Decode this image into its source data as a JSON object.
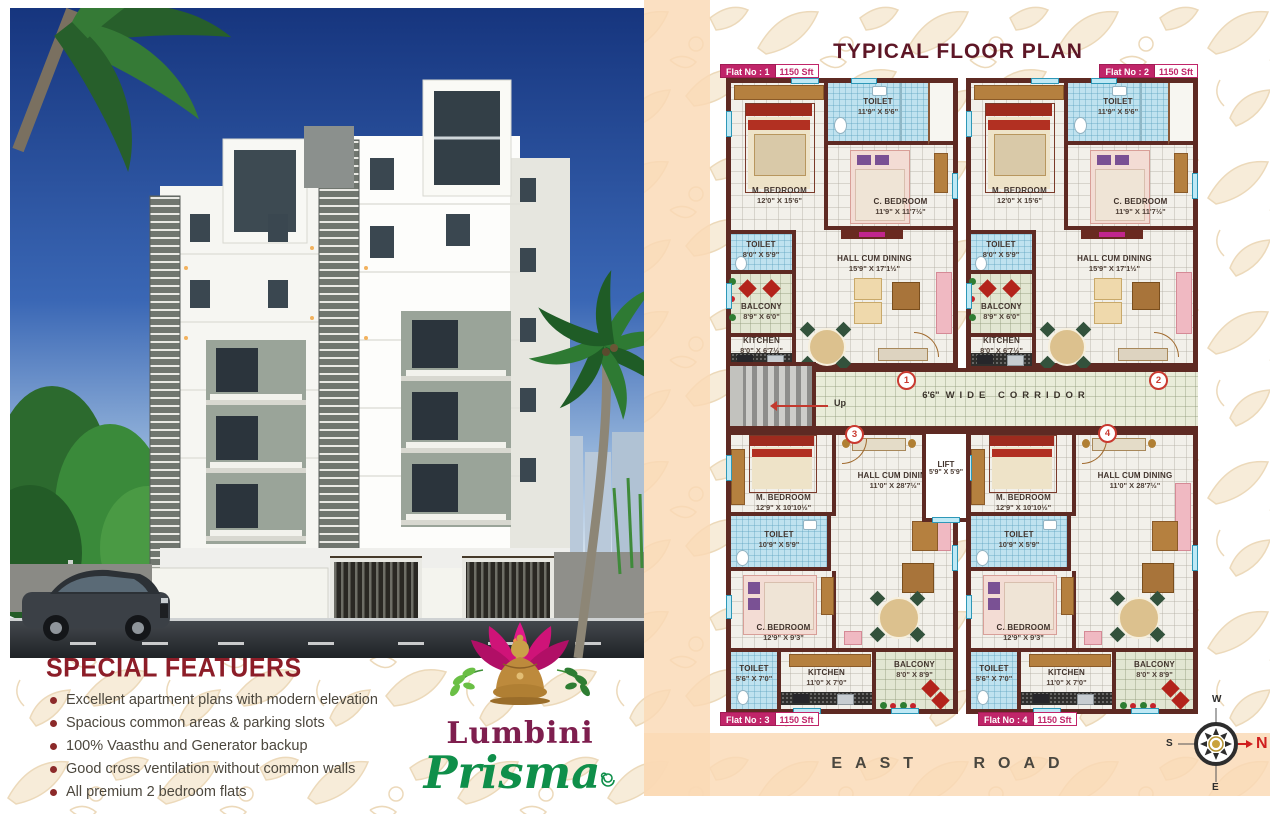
{
  "title": "TYPICAL FLOOR PLAN",
  "road_label": "EAST ROAD",
  "features": {
    "title": "SPECIAL FEATUERS",
    "items": [
      "Excellent apartment plans with modern elevation",
      "Spacious common areas & parking slots",
      "100% Vaasthu and Generator backup",
      "Good cross ventilation without common walls",
      "All premium 2 bedroom flats"
    ]
  },
  "logo": {
    "name": "Lumbini",
    "subname": "Prisma"
  },
  "flats": {
    "tags": [
      {
        "no": "Flat No : 1",
        "area": "1150 Sft"
      },
      {
        "no": "Flat No : 2",
        "area": "1150 Sft"
      },
      {
        "no": "Flat No : 3",
        "area": "1150 Sft"
      },
      {
        "no": "Flat No : 4",
        "area": "1150 Sft"
      }
    ],
    "type_top": {
      "m_bedroom": {
        "name": "M. BEDROOM",
        "dims": "12'0\" X 15'6\""
      },
      "toilet1": {
        "name": "TOILET",
        "dims": "11'9\" X 5'6\""
      },
      "c_bedroom": {
        "name": "C. BEDROOM",
        "dims": "11'9\" X 11'7½\""
      },
      "toilet2": {
        "name": "TOILET",
        "dims": "8'0\" X 5'9\""
      },
      "balcony": {
        "name": "BALCONY",
        "dims": "8'9\" X 6'0\""
      },
      "kitchen": {
        "name": "KITCHEN",
        "dims": "8'0\" X 6'7½\""
      },
      "hall": {
        "name": "HALL CUM DINING",
        "dims": "15'9\" X 17'1½\""
      }
    },
    "type_bottom": {
      "m_bedroom": {
        "name": "M. BEDROOM",
        "dims": "12'9\" X 10'10½\""
      },
      "hall": {
        "name": "HALL CUM DINING",
        "dims": "11'0\" X 28'7½\""
      },
      "toilet1": {
        "name": "TOILET",
        "dims": "10'9\" X 5'9\""
      },
      "c_bedroom": {
        "name": "C. BEDROOM",
        "dims": "12'9\" X 9'3\""
      },
      "toilet2": {
        "name": "TOILET",
        "dims": "5'6\" X 7'0\""
      },
      "kitchen": {
        "name": "KITCHEN",
        "dims": "11'0\" X 7'0\""
      },
      "balcony": {
        "name": "BALCONY",
        "dims": "8'0\" X 8'9\""
      }
    }
  },
  "corridor": {
    "size": "6'6\"",
    "text": "WIDE CORRIDOR",
    "up": "Up"
  },
  "lift": {
    "name": "LIFT",
    "dims": "5'9\" X 5'9\""
  },
  "markers": [
    "1",
    "2",
    "3",
    "4"
  ],
  "compass": {
    "n": "N",
    "e": "E",
    "s": "S",
    "w": "W"
  },
  "colors": {
    "wall": "#5e2a23",
    "tag_magenta": "#c02569",
    "title_maroon": "#5d1626",
    "features_maroon": "#8c1d28",
    "logo_green": "#0f8f4a",
    "logo_maroon": "#7e1e4e",
    "toilet_blue": "#bfe2ef",
    "corridor_green": "#e9ecd9",
    "marker_red": "#c93a30",
    "peach_band": "#fad9b4"
  }
}
